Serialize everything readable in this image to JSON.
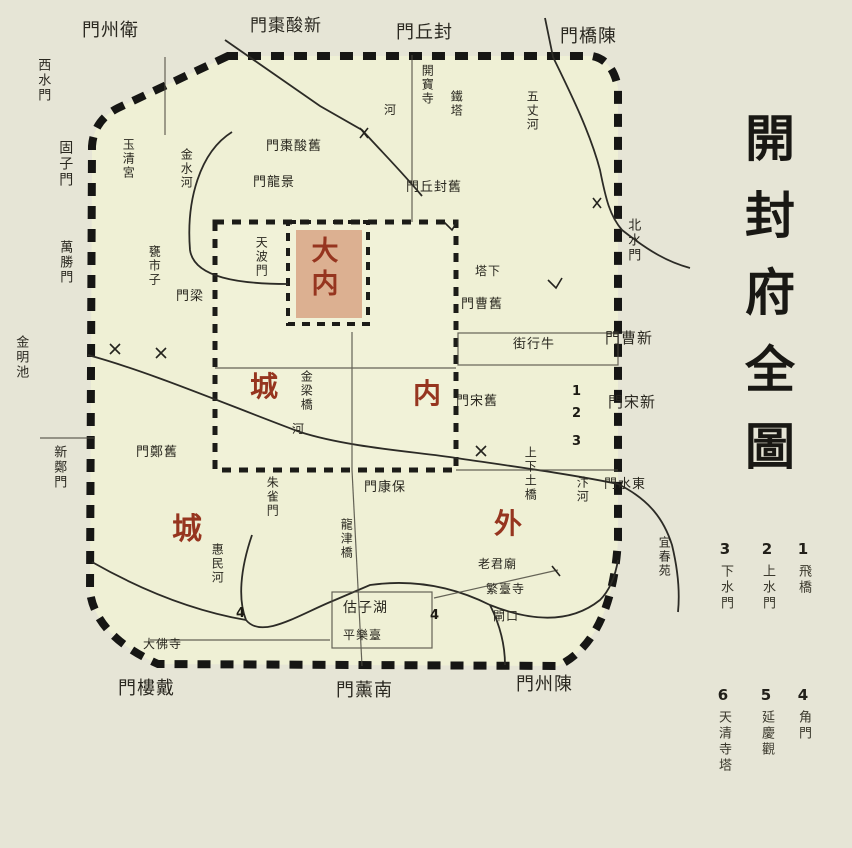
{
  "title": "開封府全圖",
  "legend": [
    {
      "num": "1",
      "label": "飛橋"
    },
    {
      "num": "2",
      "label": "上水門"
    },
    {
      "num": "3",
      "label": "下水門"
    },
    {
      "num": "4",
      "label": "角門"
    },
    {
      "num": "5",
      "label": "延慶觀"
    },
    {
      "num": "6",
      "label": "天清寺塔"
    }
  ],
  "areas": {
    "palace": "大内",
    "inner_nei": "内",
    "inner_cheng": "城",
    "outer_wai": "外",
    "outer_cheng": "城"
  },
  "outer_gates": {
    "north": [
      "門州衛",
      "門棗酸新",
      "門丘封",
      "門橋陳"
    ],
    "south": [
      "門樓戴",
      "門薰南",
      "門州陳"
    ],
    "east": [
      "門曹新",
      "門宋新",
      "門水東",
      "北水門"
    ],
    "west": [
      "西水門",
      "固子門",
      "萬勝門",
      "新鄭門"
    ]
  },
  "inner_gates": [
    "門棗酸舊",
    "門龍景",
    "門丘封舊",
    "門曹舊",
    "門宋舊",
    "門鄭舊",
    "門梁",
    "門康保",
    "朱雀門",
    "天波門"
  ],
  "rivers": [
    "金水河",
    "五丈河",
    "汴河",
    "惠民河",
    "河",
    "河"
  ],
  "bridges": [
    "金梁橋",
    "龍津橋",
    "上下土橋"
  ],
  "places": [
    "玉清宮",
    "甕市子",
    "開寶寺",
    "鐵塔",
    "金明池",
    "宜春苑",
    "街行牛",
    "塔下",
    "估子湖",
    "平樂臺",
    "老君廟",
    "繁臺寺",
    "閘口",
    "大佛寺"
  ],
  "markers": [
    "1",
    "2",
    "3",
    "4",
    "4"
  ]
}
